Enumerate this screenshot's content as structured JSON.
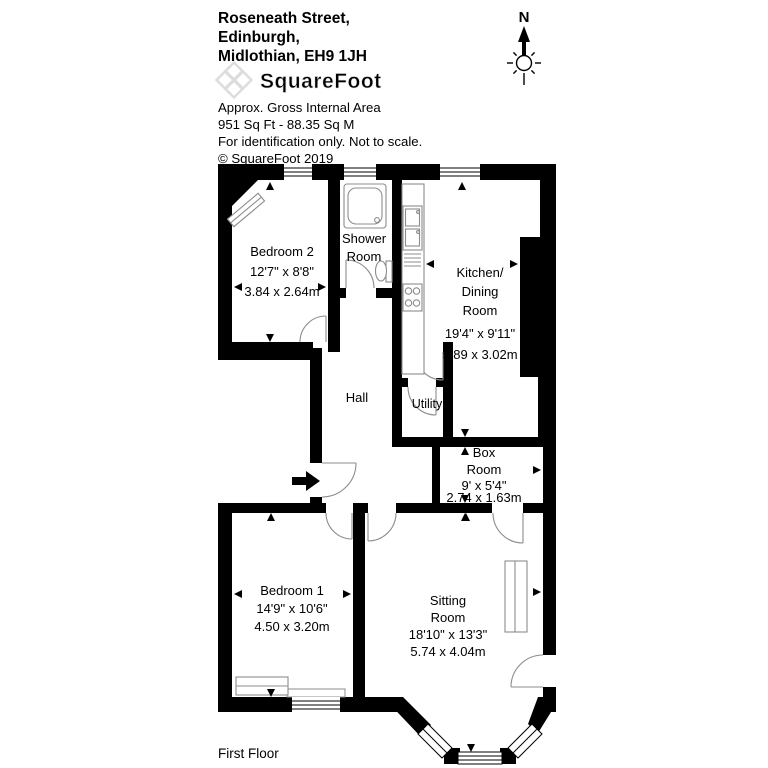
{
  "header": {
    "address_line1": "Roseneath Street,",
    "address_line2": "Edinburgh,",
    "address_line3": "Midlothian, EH9 1JH",
    "logo_text": "SquareFoot",
    "area_line1": "Approx. Gross Internal Area",
    "area_line2": "951 Sq Ft - 88.35 Sq M",
    "disclaimer": "For identification only. Not to scale.",
    "copyright": "© SquareFoot 2019"
  },
  "compass": {
    "north_label": "N"
  },
  "rooms": {
    "bedroom2": {
      "name": "Bedroom 2",
      "imperial": "12'7\" x 8'8\"",
      "metric": "3.84 x 2.64m"
    },
    "shower_room": {
      "name_line1": "Shower",
      "name_line2": "Room"
    },
    "kitchen": {
      "name_line1": "Kitchen/",
      "name_line2": "Dining",
      "name_line3": "Room",
      "imperial": "19'4\" x 9'11\"",
      "metric": "5.89 x 3.02m"
    },
    "hall": {
      "name": "Hall"
    },
    "utility": {
      "name": "Utility"
    },
    "box_room": {
      "name_line1": "Box",
      "name_line2": "Room",
      "imperial": "9' x 5'4\"",
      "metric": "2.74 x 1.63m"
    },
    "bedroom1": {
      "name": "Bedroom 1",
      "imperial": "14'9\" x 10'6\"",
      "metric": "4.50 x 3.20m"
    },
    "sitting_room": {
      "name_line1": "Sitting",
      "name_line2": "Room",
      "imperial": "18'10\" x 13'3\"",
      "metric": "5.74 x 4.04m"
    }
  },
  "footer": {
    "floor_label": "First Floor"
  },
  "colors": {
    "wall": "#000000",
    "fixture": "#8c8c8c",
    "logo": "#e9e9e9"
  }
}
